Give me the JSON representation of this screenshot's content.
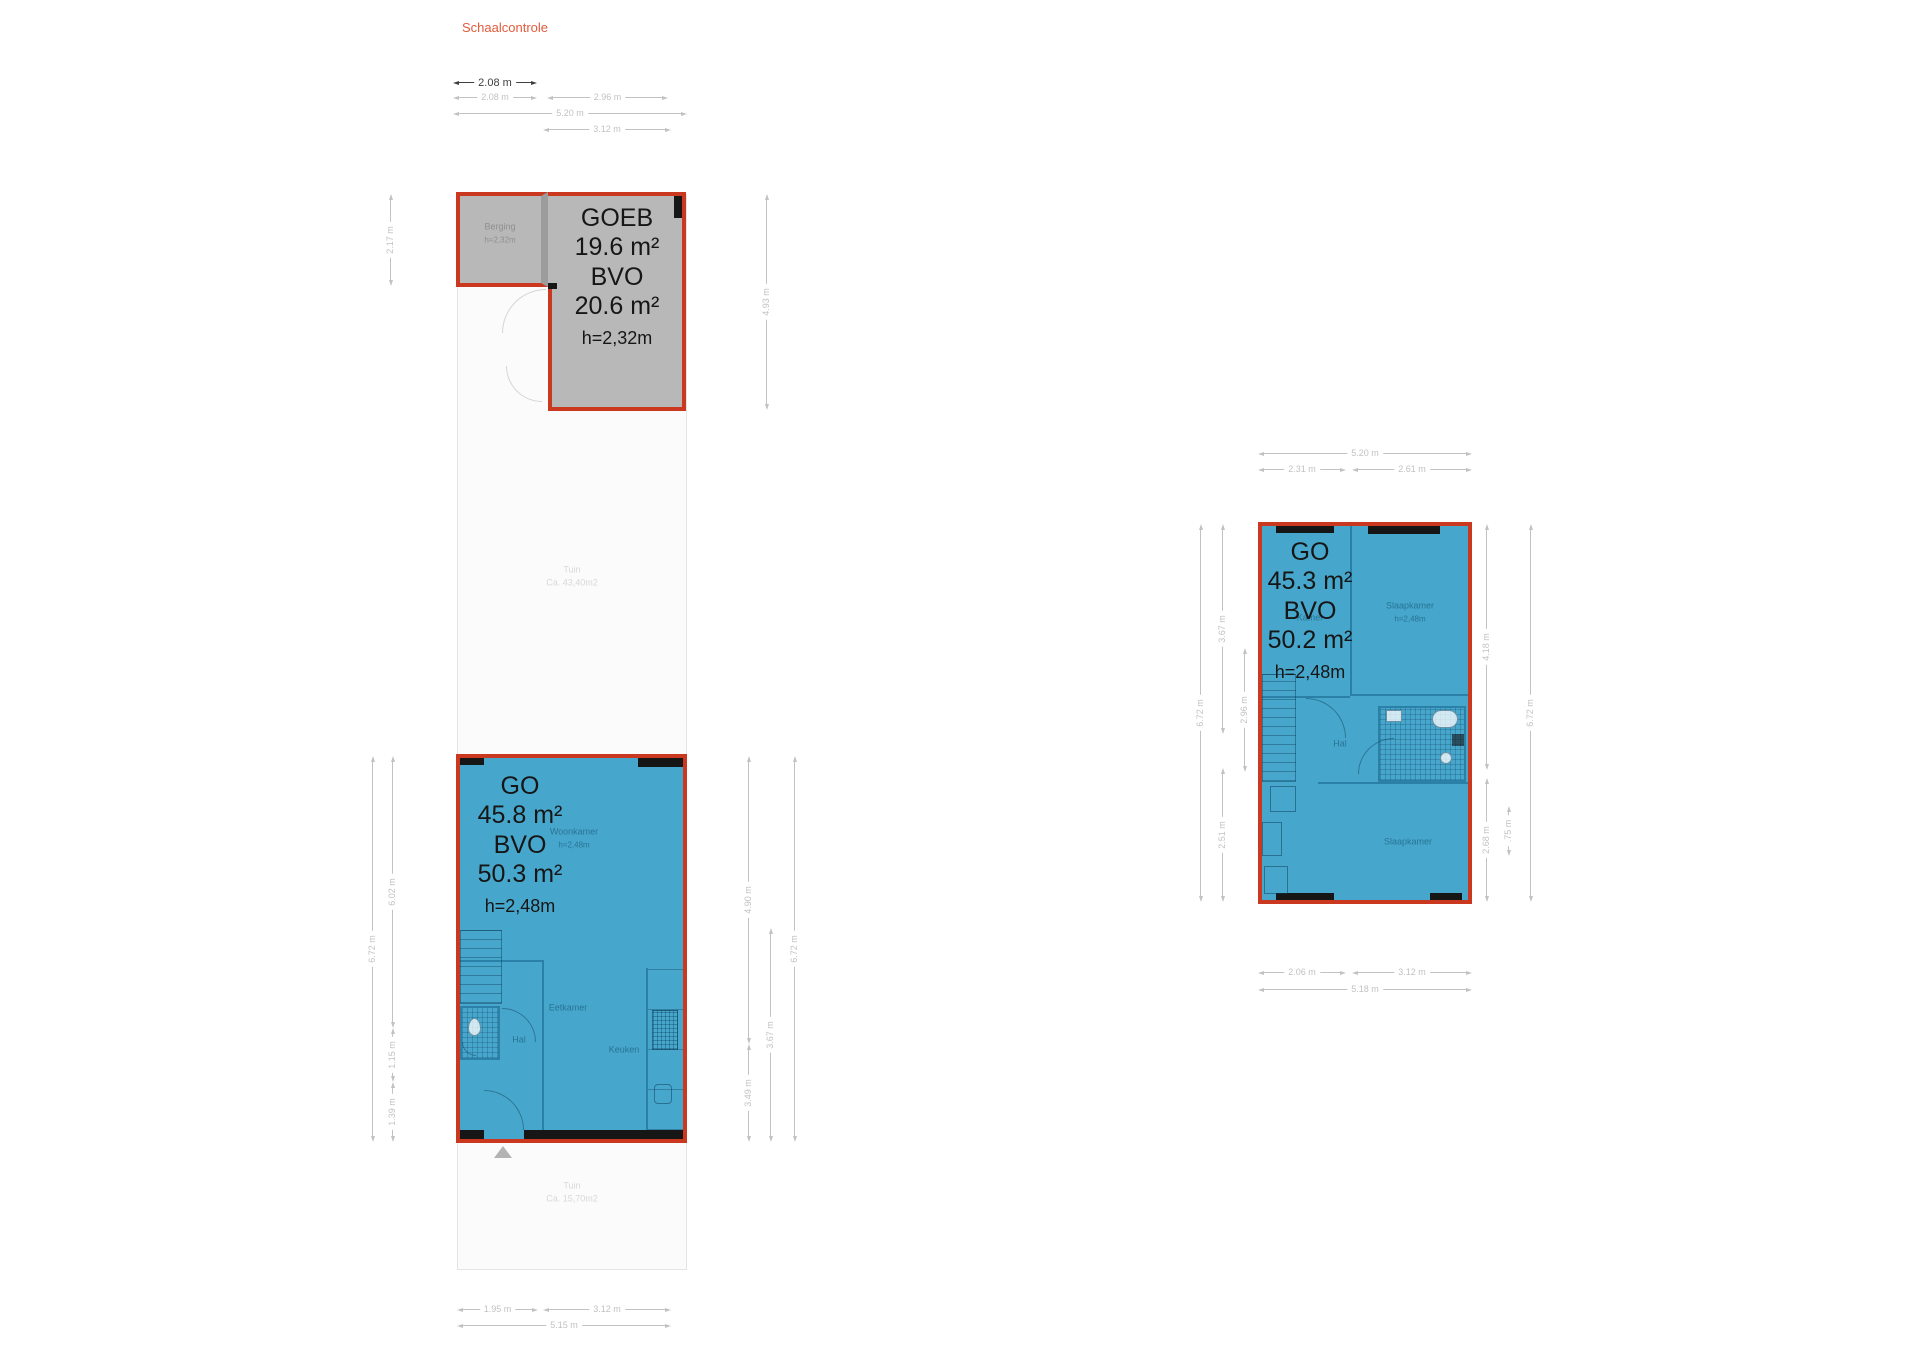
{
  "scale": {
    "label": "Schaalcontrole",
    "value": "2.08 m"
  },
  "colors": {
    "red": "#c9381f",
    "blue": "#47a6cb",
    "grey": "#b8b8b8"
  },
  "left_unit": {
    "dims_top": {
      "seg1": "2.08 m",
      "seg2": "2.96 m",
      "total": "5.20 m",
      "right": "3.12 m"
    },
    "storage": {
      "block": {
        "title": "GOEB",
        "area": "19.6 m²",
        "bvo": "BVO",
        "bvo_area": "20.6 m²",
        "height": "h=2,32m"
      },
      "room": {
        "name": "Berging",
        "height": "h=2,32m"
      },
      "dim_left": "2.17 m",
      "dim_right": "4.93 m"
    },
    "garden_top": {
      "name": "Tuin",
      "area": "Ca. 43,40m2"
    },
    "garden_bottom": {
      "name": "Tuin",
      "area": "Ca. 15,70m2"
    },
    "floor": {
      "block": {
        "title": "GO",
        "area": "45.8 m²",
        "bvo": "BVO",
        "bvo_area": "50.3 m²",
        "height": "h=2,48m"
      },
      "rooms": {
        "living": "Woonkamer",
        "living_h": "h=2,48m",
        "dining": "Eetkamer",
        "hall": "Hal",
        "kitchen": "Keuken"
      }
    },
    "dims_left": {
      "outer": "6.72 m",
      "top": "6.02 m",
      "mid": "1.15 m",
      "bottom": "1.39 m"
    },
    "dims_right": {
      "top": "4.90 m",
      "bottom": "3.49 m",
      "mid": "3.67 m",
      "outer": "6.72 m"
    },
    "dims_bottom": {
      "seg1": "1.95 m",
      "seg2": "3.12 m",
      "total": "5.15 m"
    }
  },
  "right_unit": {
    "dims_top": {
      "total": "5.20 m",
      "seg1": "2.31 m",
      "seg2": "2.61 m"
    },
    "floor": {
      "block": {
        "title": "GO",
        "area": "45.3 m²",
        "bvo": "BVO",
        "bvo_area": "50.2 m²",
        "height": "h=2,48m"
      },
      "rooms": {
        "bedroom1": "Slaapkamer",
        "bedroom1_h": "h=2,48m",
        "kamer": "Kamer",
        "hall": "Hal",
        "bedroom2": "Slaapkamer"
      }
    },
    "dims_left": {
      "outer": "6.72 m",
      "top": "3.67 m",
      "mid": "2.96 m",
      "bottom": "2.51 m"
    },
    "dims_right": {
      "top": "4.18 m",
      "small": ".75 m",
      "bottom": "2.68 m",
      "outer": "6.72 m"
    },
    "dims_bottom": {
      "seg1": "2.06 m",
      "seg2": "3.12 m",
      "total": "5.18 m"
    }
  }
}
